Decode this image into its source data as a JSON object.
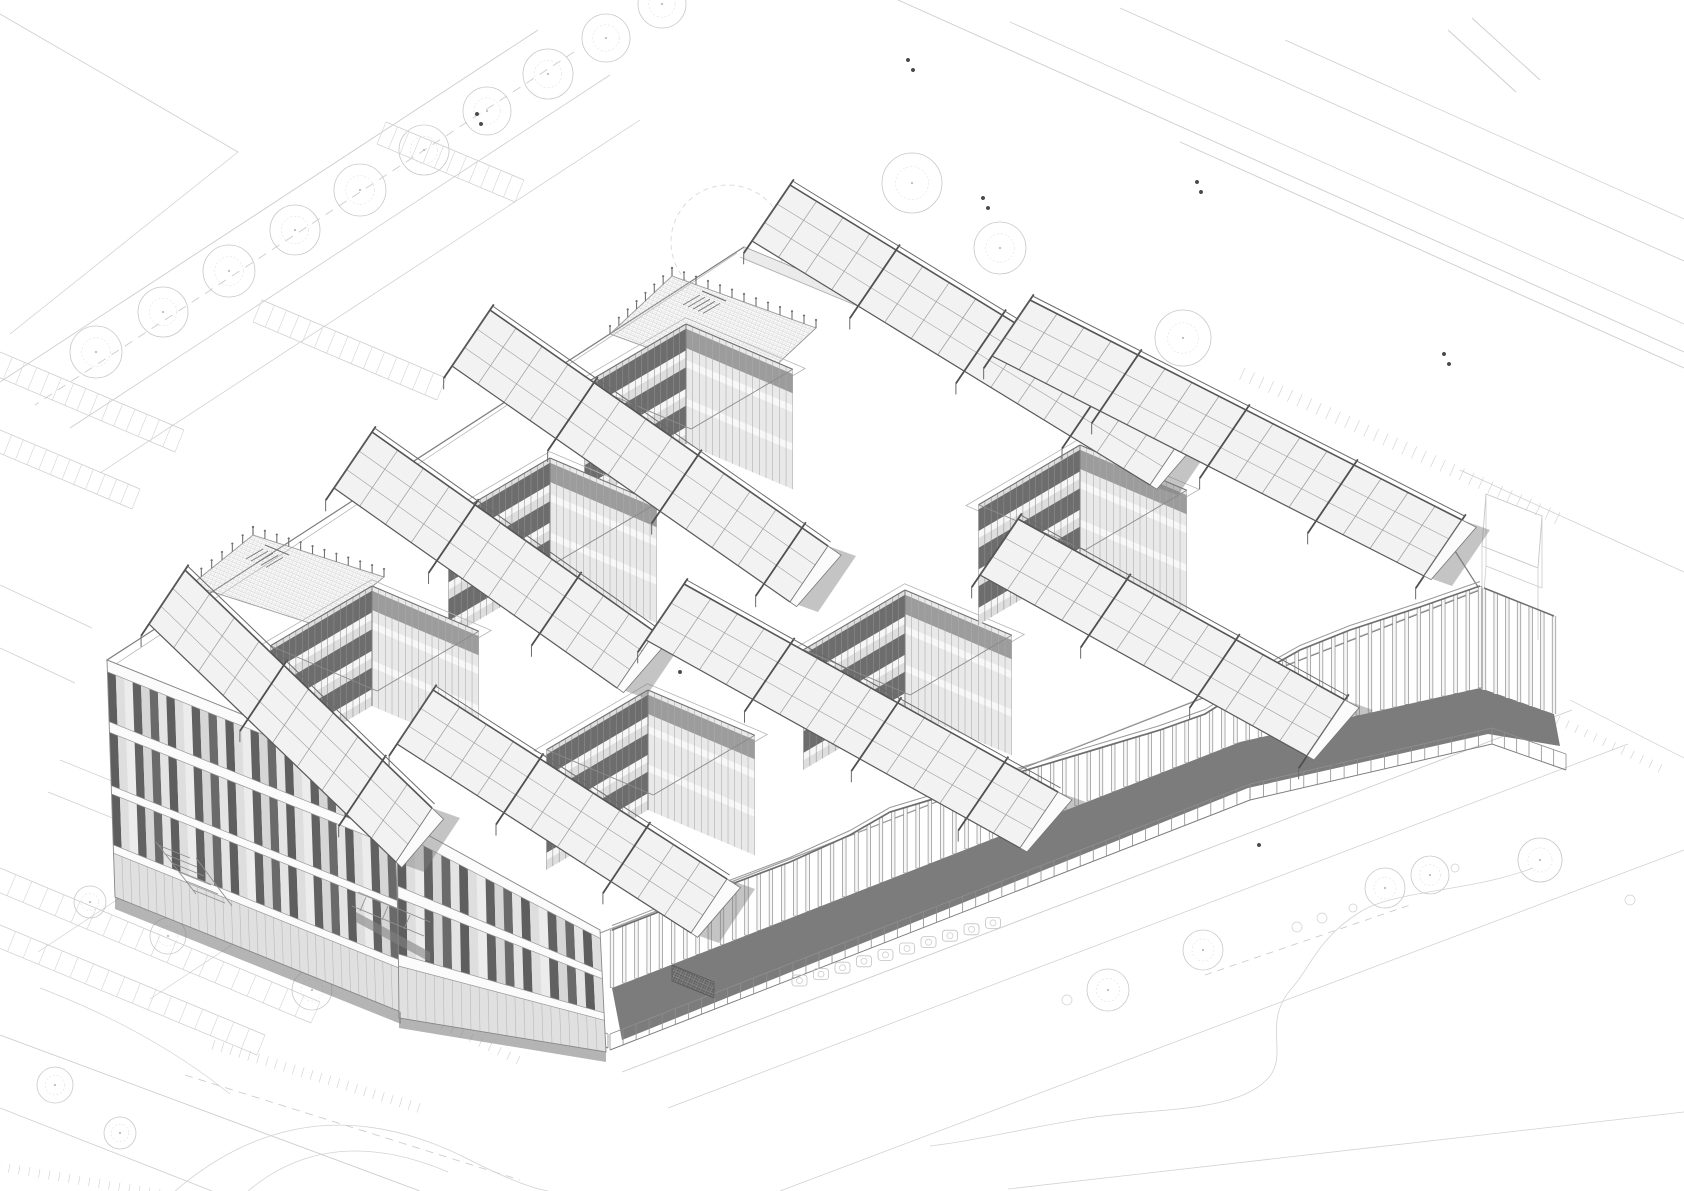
{
  "meta": {
    "drawing_type": "architectural axonometric line drawing",
    "subject": "three-storey courtyard office building with sawtooth roof skylights and vertical-fin screen facade",
    "visible_text": "",
    "courtyard_count": 6,
    "skylight_bank_count": 8,
    "roof_terrace_count": 2,
    "storeys": 3
  },
  "palette": {
    "paper": "#ffffff",
    "site_line": "#cdcdcd",
    "site_line_soft": "#d8d8d8",
    "edge_mid": "#8a8a8a",
    "edge_dark": "#4f4f4f",
    "glass_light": "#dedede",
    "panel_dark": "#5e5e5e",
    "shadow_band": "#7c7c7c",
    "shadow_soft": "#9a9a9a",
    "floor_gray": "#c9c9c9"
  },
  "site": {
    "lines": [
      [
        538,
        30,
        0,
        382,
        0.9
      ],
      [
        610,
        75,
        70,
        428,
        0.8
      ],
      [
        640,
        120,
        100,
        473,
        0.7
      ],
      [
        0,
        14,
        238,
        152,
        0.8
      ],
      [
        238,
        152,
        10,
        334,
        0.7
      ],
      [
        0,
        585,
        92,
        628,
        0.7
      ],
      [
        0,
        648,
        75,
        683,
        0.7
      ],
      [
        898,
        0,
        1684,
        352,
        0.9
      ],
      [
        1010,
        22,
        1684,
        324,
        0.7
      ],
      [
        1120,
        8,
        1684,
        261,
        0.8
      ],
      [
        1285,
        40,
        1684,
        219,
        0.7
      ],
      [
        1180,
        142,
        1684,
        368,
        0.9
      ],
      [
        1460,
        470,
        1684,
        572,
        0.7
      ],
      [
        1448,
        30,
        1516,
        92,
        0.9
      ],
      [
        1472,
        18,
        1540,
        80,
        0.9
      ],
      [
        0,
        1035,
        420,
        1191,
        0.9
      ],
      [
        0,
        1108,
        212,
        1191,
        0.8
      ],
      [
        150,
        878,
        38,
        952,
        0.6
      ],
      [
        262,
        925,
        150,
        999,
        0.6
      ],
      [
        60,
        760,
        372,
        886,
        0.7
      ],
      [
        48,
        792,
        360,
        918,
        0.7
      ],
      [
        622,
        1072,
        1572,
        710,
        0.9
      ],
      [
        668,
        1108,
        1628,
        744,
        0.7
      ],
      [
        780,
        1191,
        1684,
        850,
        0.7
      ],
      [
        1570,
        700,
        1684,
        758,
        0.7
      ]
    ],
    "dashes": [
      [
        574,
        52,
        35,
        405,
        "9 7"
      ],
      [
        185,
        1075,
        520,
        1180,
        "8 6"
      ],
      [
        1205,
        975,
        1410,
        905,
        "7 6"
      ]
    ],
    "paths": [
      [
        "M1533,868 C1470,892 1395,890 1360,912 C1318,938 1310,968 1292,988 C1262,1022 1288,1052 1270,1076 C1240,1114 1150,1108 1088,1118 C1030,1127 980,1140 930,1146",
        0.8
      ],
      [
        "M175,1191 Q305,1080 462,1156 Q520,1186 548,1191",
        0.8
      ],
      [
        "M248,1191 Q330,1122 448,1172",
        0.7
      ],
      [
        "M1008,1189 C1190,1168 1430,1140 1684,1112",
        0.8
      ],
      [
        "M40,988 Q150,1030 230,1094",
        0.7
      ]
    ],
    "parking_rows": [
      {
        "a": [
          386,
          122
        ],
        "b": [
          524,
          180
        ],
        "off": [
          -9,
          22
        ],
        "n": 12
      },
      {
        "a": [
          262,
          300
        ],
        "b": [
          446,
          378
        ],
        "off": [
          -9,
          22
        ],
        "n": 15
      },
      {
        "a": [
          0,
          352
        ],
        "b": [
          184,
          430
        ],
        "off": [
          -9,
          22
        ],
        "n": 15
      },
      {
        "a": [
          0,
          430
        ],
        "b": [
          140,
          489
        ],
        "off": [
          -8,
          20
        ],
        "n": 12
      },
      {
        "a": [
          0,
          868
        ],
        "b": [
          320,
          1002
        ],
        "off": [
          -9,
          21
        ],
        "n": 20
      },
      {
        "a": [
          0,
          925
        ],
        "b": [
          265,
          1035
        ],
        "off": [
          -8,
          20
        ],
        "n": 17
      }
    ],
    "tick_bands": [
      {
        "a": [
          215,
          1040
        ],
        "b": [
          420,
          1103
        ],
        "len": 10,
        "n": 24
      },
      {
        "a": [
          370,
          986
        ],
        "b": [
          520,
          1056
        ],
        "len": 9,
        "n": 17
      },
      {
        "a": [
          0,
          1162
        ],
        "b": [
          170,
          1191
        ],
        "len": 9,
        "n": 18
      },
      {
        "a": [
          1245,
          368
        ],
        "b": [
          1560,
          512
        ],
        "len": 13,
        "n": 34
      },
      {
        "a": [
          1560,
          716
        ],
        "b": [
          1662,
          764
        ],
        "len": 9,
        "n": 12
      }
    ],
    "circles": [
      [
        728,
        242,
        57,
        "f"
      ],
      [
        96,
        352,
        26,
        "t"
      ],
      [
        163,
        312,
        25,
        "t"
      ],
      [
        229,
        271,
        26,
        "t"
      ],
      [
        295,
        230,
        25,
        "t"
      ],
      [
        360,
        190,
        26,
        "t"
      ],
      [
        424,
        150,
        25,
        "t"
      ],
      [
        487,
        111,
        24,
        "t"
      ],
      [
        548,
        74,
        25,
        "t"
      ],
      [
        606,
        38,
        24,
        "t"
      ],
      [
        662,
        4,
        24,
        "t"
      ],
      [
        912,
        183,
        30,
        "t"
      ],
      [
        1000,
        248,
        26,
        "t"
      ],
      [
        1183,
        338,
        28,
        "t"
      ],
      [
        1108,
        990,
        21,
        "t"
      ],
      [
        1203,
        950,
        20,
        "t"
      ],
      [
        1385,
        888,
        20,
        "t"
      ],
      [
        1430,
        875,
        19,
        "t"
      ],
      [
        1540,
        860,
        22,
        "t"
      ],
      [
        1297,
        927,
        5,
        "s"
      ],
      [
        1322,
        918,
        5,
        "s"
      ],
      [
        1353,
        908,
        4,
        "s"
      ],
      [
        1067,
        1000,
        5,
        "s"
      ],
      [
        1455,
        868,
        4,
        "s"
      ],
      [
        1630,
        900,
        5,
        "s"
      ],
      [
        90,
        902,
        16,
        "t"
      ],
      [
        168,
        936,
        18,
        "t"
      ],
      [
        312,
        990,
        20,
        "t"
      ],
      [
        55,
        1085,
        18,
        "t"
      ],
      [
        120,
        1133,
        16,
        "t"
      ]
    ],
    "dots": [
      [
        477,
        114
      ],
      [
        481,
        124
      ],
      [
        983,
        198
      ],
      [
        988,
        208
      ],
      [
        1197,
        182
      ],
      [
        1201,
        192
      ],
      [
        1444,
        354
      ],
      [
        1449,
        364
      ],
      [
        680,
        672
      ],
      [
        1259,
        845
      ],
      [
        908,
        60
      ],
      [
        913,
        70
      ]
    ],
    "racks": {
      "start": [
        792,
        986
      ],
      "step": [
        21.5,
        -6.4
      ],
      "n": 10,
      "w": 15,
      "h": 11
    }
  },
  "building": {
    "roof_outline": [
      [
        744,
        247
      ],
      [
        1448,
        540
      ],
      [
        1480,
        590
      ],
      [
        600,
        933
      ],
      [
        397,
        820
      ],
      [
        395,
        777
      ],
      [
        107,
        660
      ]
    ],
    "inner_lines": [
      [
        740,
        257,
        1440,
        548
      ],
      [
        737,
        253,
        116,
        664
      ],
      [
        113,
        668,
        391,
        781
      ],
      [
        402,
        827,
        596,
        936
      ],
      [
        600,
        933,
        1478,
        590
      ]
    ],
    "ne_sliver": [
      [
        744,
        247
      ],
      [
        1448,
        540
      ],
      [
        1448,
        552
      ],
      [
        744,
        259
      ]
    ],
    "courtyards": [
      {
        "T": [
          686,
          324
        ]
      },
      {
        "T": [
          550,
          458
        ]
      },
      {
        "T": [
          372,
          586
        ]
      },
      {
        "T": [
          648,
          690
        ]
      },
      {
        "T": [
          905,
          590
        ]
      },
      {
        "T": [
          1080,
          445
        ]
      }
    ],
    "courtyard_size": 116,
    "courtyard_depth": 120,
    "banks": [
      {
        "s": [
          790,
          185
        ],
        "e": [
          1188,
          429
        ],
        "w": [
          -38,
          56
        ],
        "cols": 15
      },
      {
        "s": [
          1030,
          300
        ],
        "e": [
          1462,
          520
        ],
        "w": [
          -38,
          56
        ],
        "cols": 16
      },
      {
        "s": [
          490,
          310
        ],
        "e": [
          828,
          546
        ],
        "w": [
          -38,
          56
        ],
        "cols": 13
      },
      {
        "s": [
          372,
          432
        ],
        "e": [
          655,
          632
        ],
        "w": [
          -38,
          56
        ],
        "cols": 11
      },
      {
        "s": [
          185,
          570
        ],
        "e": [
          432,
          808
        ],
        "w": [
          -36,
          54
        ],
        "cols": 10
      },
      {
        "s": [
          684,
          584
        ],
        "e": [
          1058,
          792
        ],
        "w": [
          -38,
          56
        ],
        "cols": 14
      },
      {
        "s": [
          433,
          690
        ],
        "e": [
          727,
          879
        ],
        "w": [
          -36,
          54
        ],
        "cols": 11
      },
      {
        "s": [
          1018,
          519
        ],
        "e": [
          1345,
          700
        ],
        "w": [
          -38,
          56
        ],
        "cols": 12
      }
    ],
    "terraces": [
      {
        "quad": [
          [
            672,
            276
          ],
          [
            816,
            328
          ],
          [
            754,
            386
          ],
          [
            610,
            334
          ]
        ],
        "stair": [
          700,
          295
        ]
      },
      {
        "quad": [
          [
            253,
            535
          ],
          [
            384,
            577
          ],
          [
            322,
            627
          ],
          [
            191,
            585
          ]
        ],
        "stair": [
          263,
          549
        ]
      }
    ],
    "facades": [
      {
        "A": [
          107,
          660
        ],
        "B": [
          393,
          775
        ],
        "C": [
          401,
          1012
        ],
        "D": [
          115,
          897
        ],
        "bands": [
          [
            0,
            0.05
          ],
          [
            0.26,
            0.305
          ],
          [
            0.53,
            0.565
          ],
          [
            0.78,
            0.815
          ]
        ],
        "ground": 0.815,
        "n": 34
      },
      {
        "A": [
          397,
          818
        ],
        "B": [
          600,
          930
        ],
        "C": [
          606,
          1052
        ],
        "D": [
          399,
          1018
        ],
        "bands": [
          [
            0,
            0.07
          ],
          [
            0.34,
            0.4
          ],
          [
            0.68,
            0.74
          ]
        ],
        "ground": 0.74,
        "n": 23
      }
    ],
    "base_shadows": [
      [
        [
          115,
          897
        ],
        [
          401,
          1012
        ],
        [
          401,
          1024
        ],
        [
          115,
          909
        ]
      ],
      [
        [
          399,
          1018
        ],
        [
          606,
          1052
        ],
        [
          606,
          1062
        ],
        [
          399,
          1028
        ]
      ],
      [
        [
          356,
          912
        ],
        [
          430,
          952
        ],
        [
          430,
          962
        ],
        [
          356,
          922
        ]
      ]
    ],
    "fin_screen": {
      "base": [
        [
          612,
          988
        ],
        [
          1240,
          742
        ],
        [
          1480,
          688
        ]
      ],
      "top": [
        [
          612,
          930
        ],
        [
          700,
          896
        ],
        [
          790,
          862
        ],
        [
          850,
          835
        ],
        [
          890,
          812
        ],
        [
          930,
          800
        ],
        [
          1020,
          772
        ],
        [
          1100,
          748
        ],
        [
          1160,
          730
        ],
        [
          1205,
          714
        ],
        [
          1240,
          692
        ],
        [
          1268,
          668
        ],
        [
          1300,
          650
        ],
        [
          1350,
          630
        ],
        [
          1420,
          607
        ],
        [
          1480,
          586
        ]
      ],
      "n": 72,
      "ret": {
        "a": [
          1484,
          690
        ],
        "b": [
          1554,
          714
        ],
        "ta": [
          1484,
          588
        ],
        "tb": [
          1554,
          616
        ],
        "n": 7
      },
      "band": [
        [
          612,
          988
        ],
        [
          1240,
          742
        ],
        [
          1480,
          688
        ],
        [
          1554,
          714
        ],
        [
          1560,
          746
        ],
        [
          1488,
          734
        ],
        [
          1248,
          788
        ],
        [
          622,
          1040
        ]
      ]
    },
    "fences": [
      {
        "pts": [
          [
            610,
            1050
          ],
          [
            1250,
            800
          ],
          [
            1492,
            744
          ],
          [
            1566,
            770
          ]
        ],
        "h": 16,
        "step": 14
      },
      {
        "pts": [
          [
            372,
            952
          ],
          [
            608,
            1048
          ]
        ],
        "h": 14,
        "step": 13
      }
    ],
    "ghost_prism": {
      "top": [
        [
          1486,
          494
        ],
        [
          1542,
          516
        ],
        [
          1538,
          568
        ],
        [
          1482,
          546
        ]
      ],
      "dz": 72
    },
    "grate": [
      [
        672,
        965
      ],
      [
        714,
        982
      ],
      [
        714,
        998
      ],
      [
        672,
        981
      ]
    ],
    "detail_lines": [
      [
        158,
        845,
        190,
        858
      ],
      [
        165,
        854,
        197,
        867
      ],
      [
        172,
        863,
        204,
        876
      ],
      [
        179,
        872,
        211,
        885
      ],
      [
        186,
        881,
        218,
        894
      ],
      [
        193,
        890,
        225,
        903
      ],
      [
        156,
        842,
        196,
        894
      ],
      [
        196,
        858,
        232,
        906
      ],
      [
        358,
        892,
        430,
        922
      ],
      [
        352,
        906,
        424,
        936
      ],
      [
        366,
        897,
        360,
        911
      ],
      [
        388,
        906,
        382,
        920
      ],
      [
        410,
        915,
        404,
        929
      ]
    ]
  }
}
